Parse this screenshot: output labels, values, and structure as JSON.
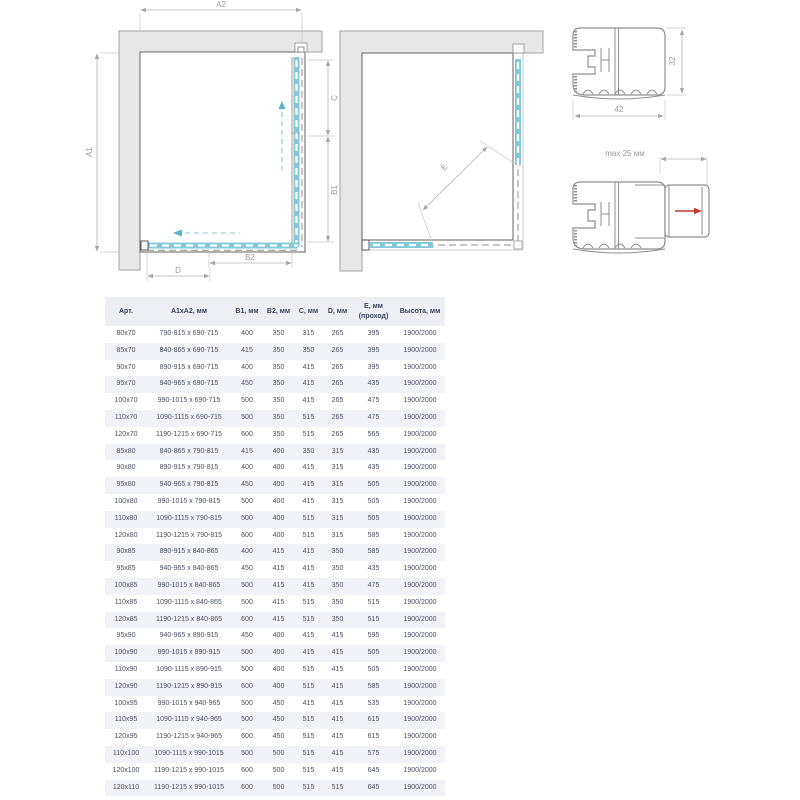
{
  "diagrams": {
    "plan_closed": {
      "labels": {
        "a2": "A2",
        "a1": "A1",
        "c": "C",
        "b1": "B1",
        "b2": "B2",
        "d": "D"
      }
    },
    "plan_open": {
      "labels": {
        "e": "E"
      }
    },
    "profile_main": {
      "labels": {
        "width": "42",
        "height": "32"
      }
    },
    "profile_adjust": {
      "labels": {
        "max": "max 25 мм"
      }
    }
  },
  "colors": {
    "glass_cyan": "#85c8d8",
    "door_cyan": "#74c0d2",
    "wall_fill": "#e7e7e7",
    "frame_stroke": "#6f6f6f",
    "dimension_gray": "#b3b3b3",
    "label_gray": "#9a9a9a",
    "red_arrow": "#c0392b",
    "header_bg": "#edeff5",
    "row_alt_bg": "#f2f3f8",
    "text": "#4a5061"
  },
  "table": {
    "columns": [
      {
        "label": "Арт.",
        "sub": ""
      },
      {
        "label": "A1xA2, мм",
        "sub": ""
      },
      {
        "label": "B1, мм",
        "sub": ""
      },
      {
        "label": "B2, мм",
        "sub": ""
      },
      {
        "label": "C, мм",
        "sub": ""
      },
      {
        "label": "D, мм",
        "sub": ""
      },
      {
        "label": "E, мм",
        "sub": "(проход)"
      },
      {
        "label": "Высота, мм",
        "sub": ""
      }
    ],
    "rows": [
      [
        "80x70",
        "790-815 x 690-715",
        "400",
        "350",
        "315",
        "265",
        "395",
        "1900/2000"
      ],
      [
        "85x70",
        "840-865 x 690-715",
        "415",
        "350",
        "350",
        "265",
        "395",
        "1900/2000"
      ],
      [
        "90x70",
        "890-915 x 690-715",
        "400",
        "350",
        "415",
        "265",
        "395",
        "1900/2000"
      ],
      [
        "95x70",
        "940-965 x 690-715",
        "450",
        "350",
        "415",
        "265",
        "435",
        "1900/2000"
      ],
      [
        "100x70",
        "990-1015 x 690-715",
        "500",
        "350",
        "415",
        "265",
        "475",
        "1900/2000"
      ],
      [
        "110x70",
        "1090-1115 x 690-715",
        "500",
        "350",
        "515",
        "265",
        "475",
        "1900/2000"
      ],
      [
        "120x70",
        "1190-1215 x 690-715",
        "600",
        "350",
        "515",
        "265",
        "565",
        "1900/2000"
      ],
      [
        "85x80",
        "840-865 x 790-815",
        "415",
        "400",
        "350",
        "315",
        "435",
        "1900/2000"
      ],
      [
        "90x80",
        "890-915 x 790-815",
        "400",
        "400",
        "415",
        "315",
        "435",
        "1900/2000"
      ],
      [
        "95x80",
        "940-965 x 790-815",
        "450",
        "400",
        "415",
        "315",
        "505",
        "1900/2000"
      ],
      [
        "100x80",
        "990-1015 x 790-815",
        "500",
        "400",
        "415",
        "315",
        "505",
        "1900/2000"
      ],
      [
        "110x80",
        "1090-1115 x 790-815",
        "500",
        "400",
        "515",
        "315",
        "505",
        "1900/2000"
      ],
      [
        "120x80",
        "1190-1215 x 790-815",
        "600",
        "400",
        "515",
        "315",
        "585",
        "1900/2000"
      ],
      [
        "90x85",
        "890-915 x 840-865",
        "400",
        "415",
        "415",
        "350",
        "585",
        "1900/2000"
      ],
      [
        "95x85",
        "940-965 x 840-865",
        "450",
        "415",
        "415",
        "350",
        "435",
        "1900/2000"
      ],
      [
        "100x85",
        "990-1015 x 840-865",
        "500",
        "415",
        "415",
        "350",
        "475",
        "1900/2000"
      ],
      [
        "110x85",
        "1090-1115 x 840-865",
        "500",
        "415",
        "515",
        "350",
        "515",
        "1900/2000"
      ],
      [
        "120x85",
        "1190-1215 x 840-865",
        "600",
        "415",
        "515",
        "350",
        "515",
        "1900/2000"
      ],
      [
        "95x90",
        "940-965 x 890-915",
        "450",
        "400",
        "415",
        "415",
        "595",
        "1900/2000"
      ],
      [
        "100x90",
        "990-1015 x 890-915",
        "500",
        "400",
        "415",
        "415",
        "505",
        "1900/2000"
      ],
      [
        "110x90",
        "1090-1115 x 890-915",
        "500",
        "400",
        "515",
        "415",
        "505",
        "1900/2000"
      ],
      [
        "120x90",
        "1190-1215 x 890-915",
        "600",
        "400",
        "515",
        "415",
        "585",
        "1900/2000"
      ],
      [
        "100x95",
        "990-1015 x 940-965",
        "500",
        "450",
        "415",
        "415",
        "535",
        "1900/2000"
      ],
      [
        "110x95",
        "1090-1115 x 940-965",
        "500",
        "450",
        "515",
        "415",
        "615",
        "1900/2000"
      ],
      [
        "120x95",
        "1190-1215 x 940-965",
        "600",
        "450",
        "515",
        "415",
        "615",
        "1900/2000"
      ],
      [
        "110x100",
        "1090-1115 x 990-1015",
        "500",
        "500",
        "515",
        "415",
        "575",
        "1900/2000"
      ],
      [
        "120x100",
        "1190-1215 x 990-1015",
        "600",
        "500",
        "515",
        "415",
        "645",
        "1900/2000"
      ],
      [
        "120x110",
        "1190-1215 x 990-1015",
        "600",
        "500",
        "515",
        "515",
        "645",
        "1900/2000"
      ]
    ]
  }
}
